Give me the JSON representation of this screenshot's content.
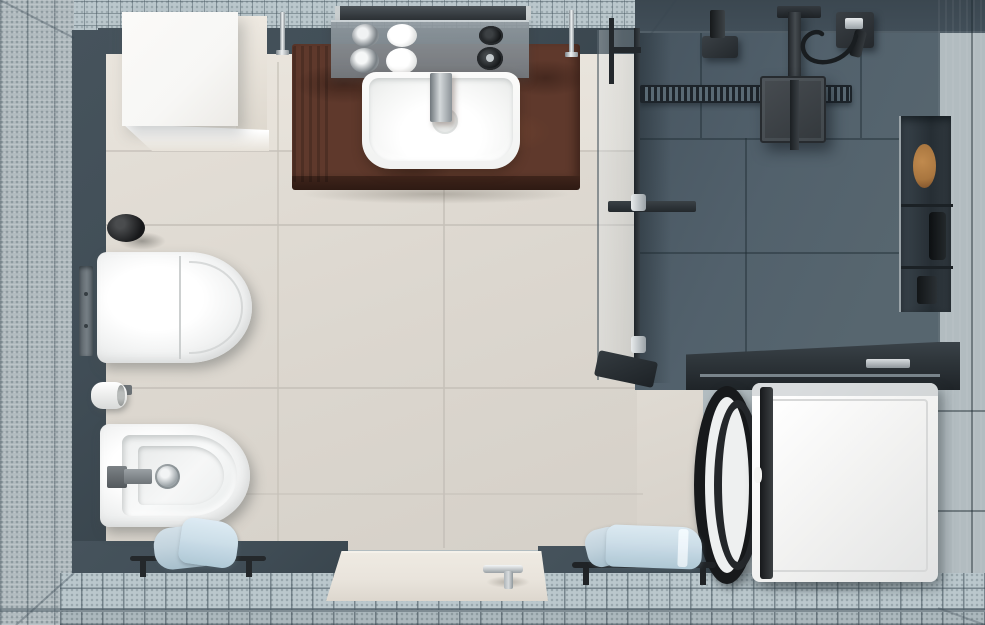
{
  "scene": {
    "type": "3d-render",
    "view": "top-down bathroom floor plan photograph, no text",
    "regions": {
      "perimeter": "light blue-grey mosaic tiled walls and floor border",
      "main_floor": "large-format beige tiles",
      "shower_zone": "dark slate-blue tiled walk-in shower, top right",
      "laundry_corner": "dark countertop with washing machine, bottom right"
    },
    "fixtures": [
      "storage-cabinet",
      "vanity-counter",
      "washbasin",
      "basin-faucet",
      "mirror-shelf",
      "soap-pumps",
      "toiletry-bottles",
      "hanging-towel-brown",
      "wall-hung-toilet",
      "flush-plate",
      "toilet-paper-roll",
      "wall-niche-left",
      "bidet",
      "bidet-faucet",
      "bidet-drain",
      "towel-rail-left",
      "towels-left",
      "entry-door",
      "door-handle",
      "towel-rail-right",
      "towels-right",
      "glass-shower-partition",
      "rain-shower-head",
      "shower-arm",
      "hand-shower",
      "shower-hose",
      "ceiling-mounts",
      "linear-shower-drain",
      "wall-niche-shelf-right",
      "laundry-countertop",
      "washing-machine",
      "washer-door-open"
    ]
  },
  "palette": {
    "mosaic_wall": "#b2bcc0",
    "mosaic_floor": "#bac7cc",
    "slate_wall": "#414e57",
    "beige_wall": "#e6e1d9",
    "beige_floor": "#dcd7cf",
    "floor_grout": "#c6c1b9",
    "shower_wall": "#57666f",
    "shower_ceiling": "#414e58",
    "shower_floor": "#4e5d68",
    "right_wall": "#5c6871",
    "counter_brown": "#5f392c",
    "counter_brown_dark": "#3f241b",
    "white_fixture": "#f7f7f5",
    "chrome": "#c9ced1",
    "black_fixture": "#1b1e20",
    "towel_blue": "#c3d4de",
    "towel_blue_dark": "#a7bfcc",
    "counter_top_dark": "#2e353a",
    "washer_white": "#f1f1f0",
    "door_beige": "#e9e4dc",
    "wood_item": "#a9763f"
  }
}
